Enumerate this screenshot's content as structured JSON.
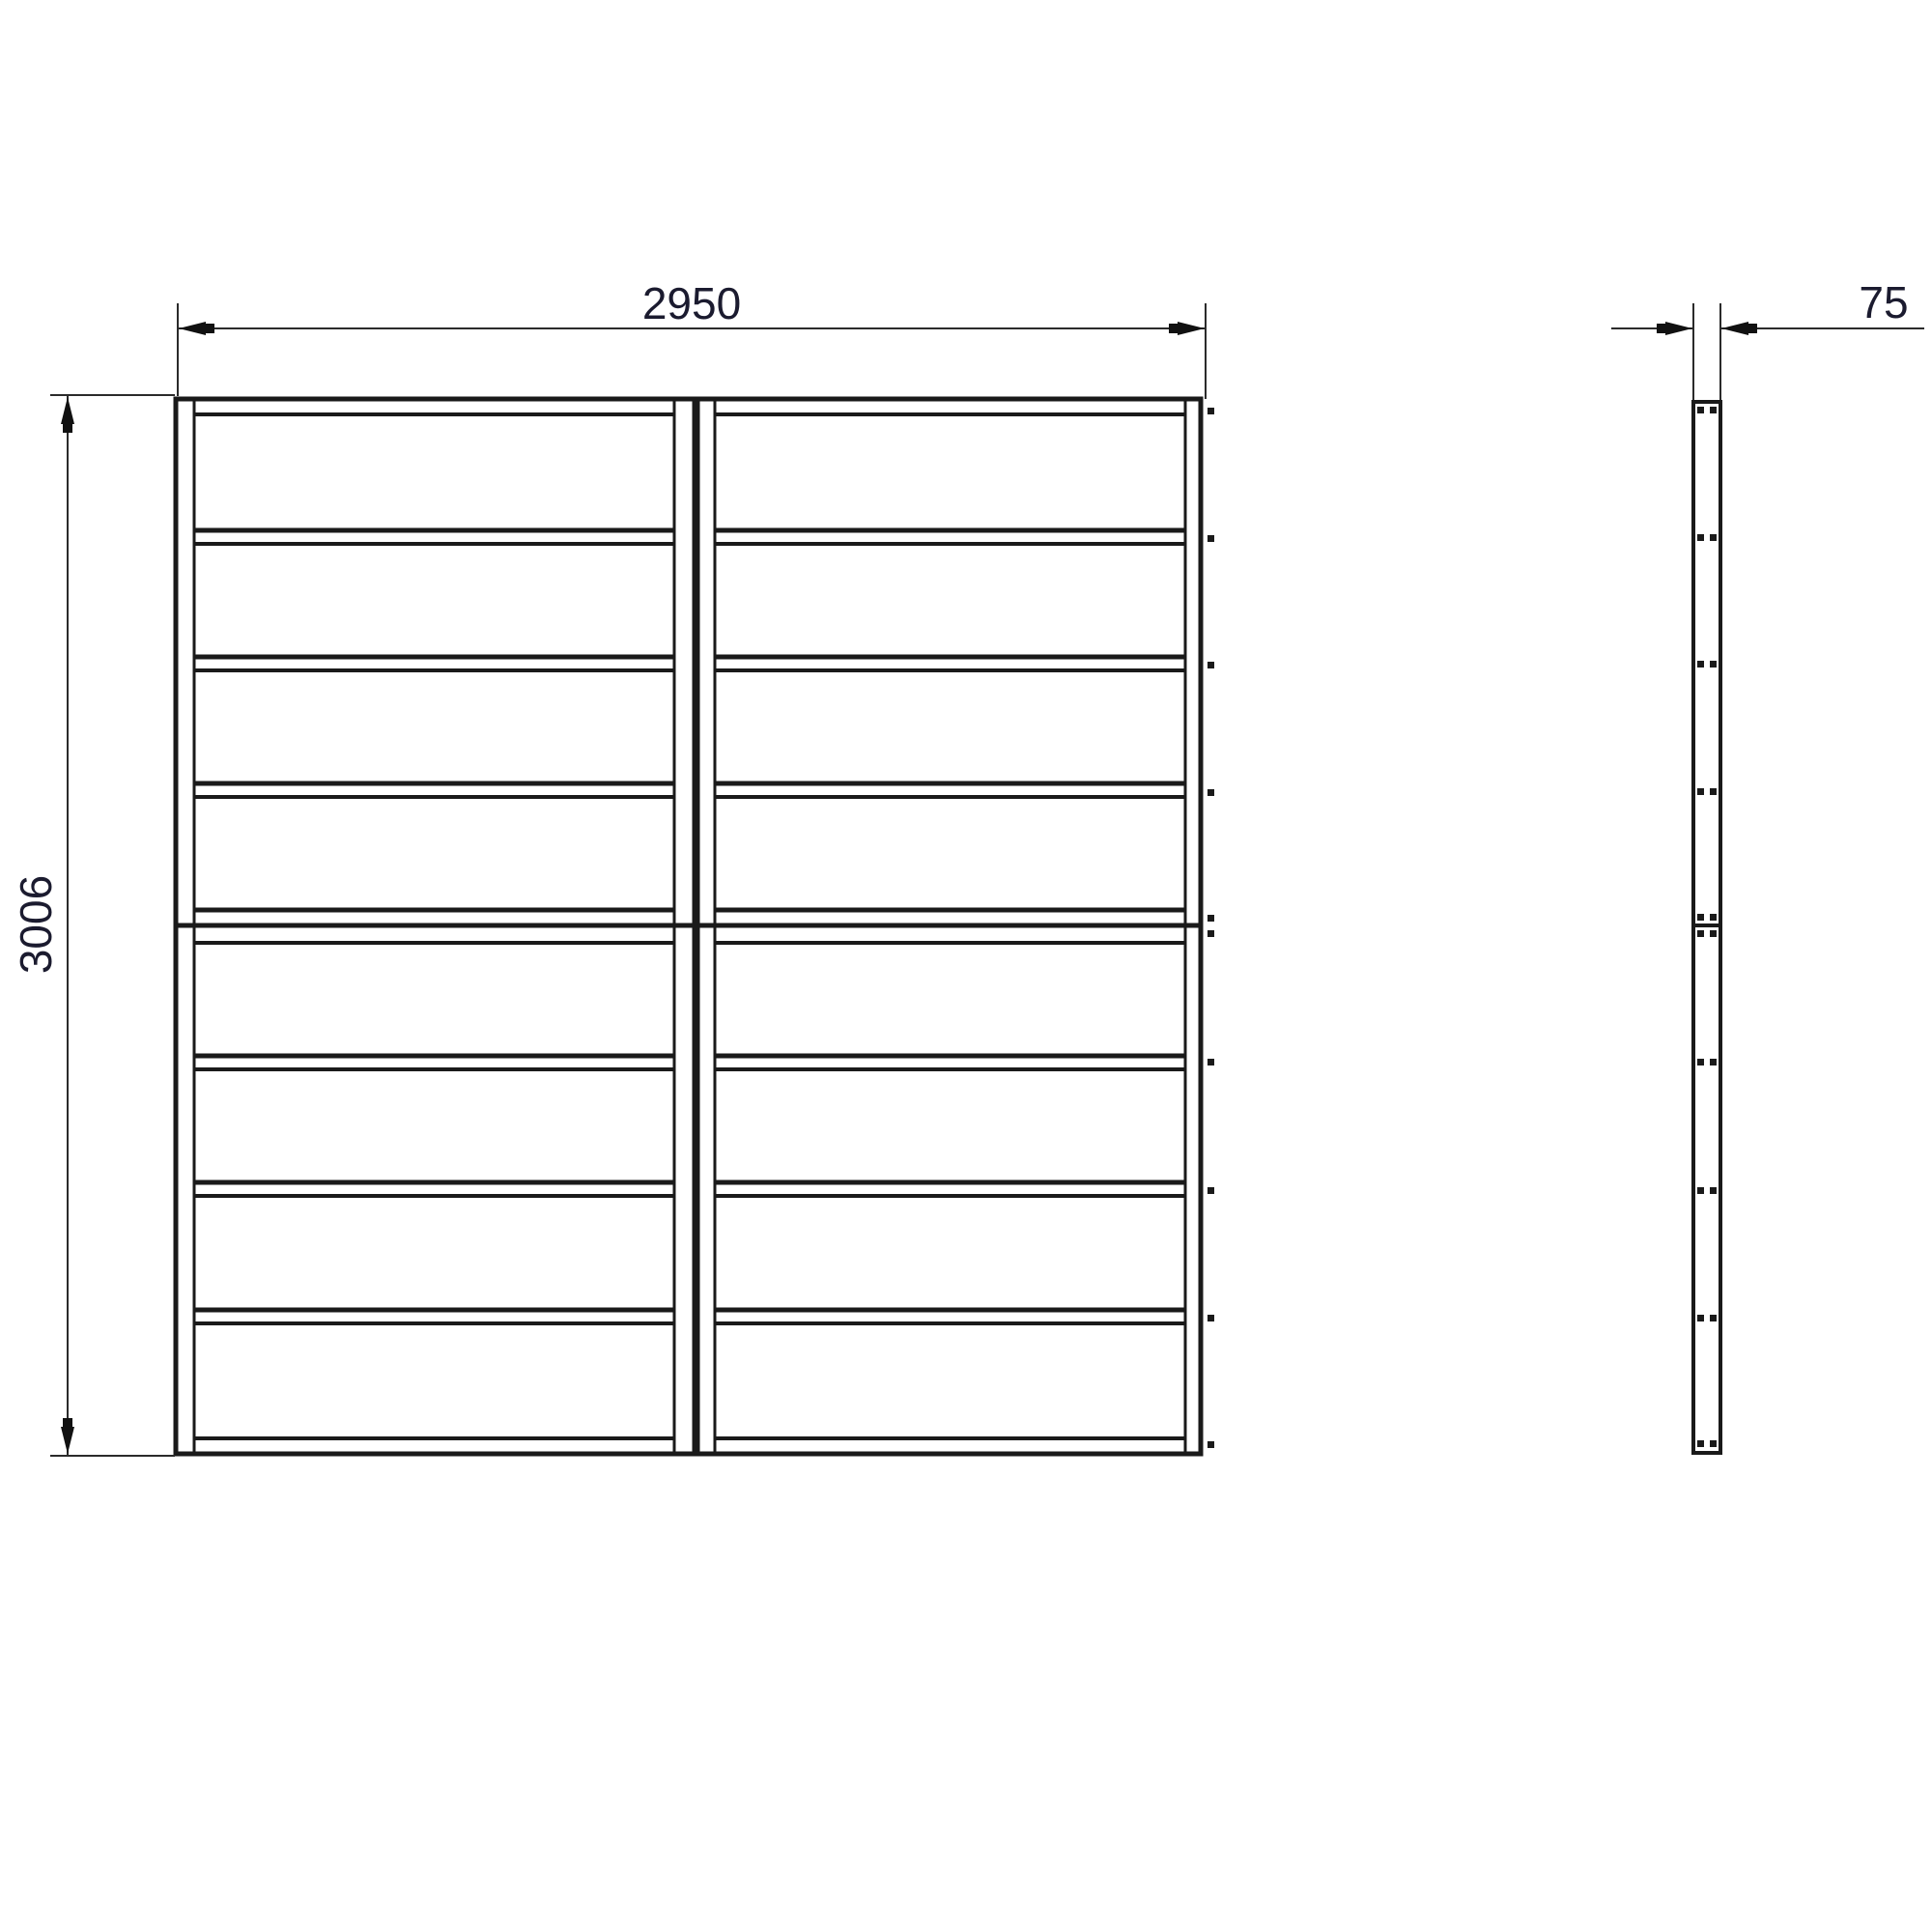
{
  "drawing": {
    "type": "technical-drawing",
    "description": "Shiplap panel pack elevation: front view of two framed board panels (two stacked sections of four boards each) and right-hand side profile view with screw fixings",
    "dimensions": {
      "width_mm": "2950",
      "height_mm": "3006",
      "thickness_mm": "75"
    },
    "front_view": {
      "panels": 2,
      "sections_per_panel": 2,
      "boards_per_section": 4,
      "boards_per_panel": 8,
      "edge_screw_rows": 10
    },
    "side_view": {
      "screw_rows": 10,
      "screws_per_row": 2,
      "sections": 2
    },
    "colors": {
      "line": "#1a1a1a",
      "dimension_line": "#2b2b2b",
      "text": "#1b1b2f",
      "background": "#ffffff"
    }
  }
}
